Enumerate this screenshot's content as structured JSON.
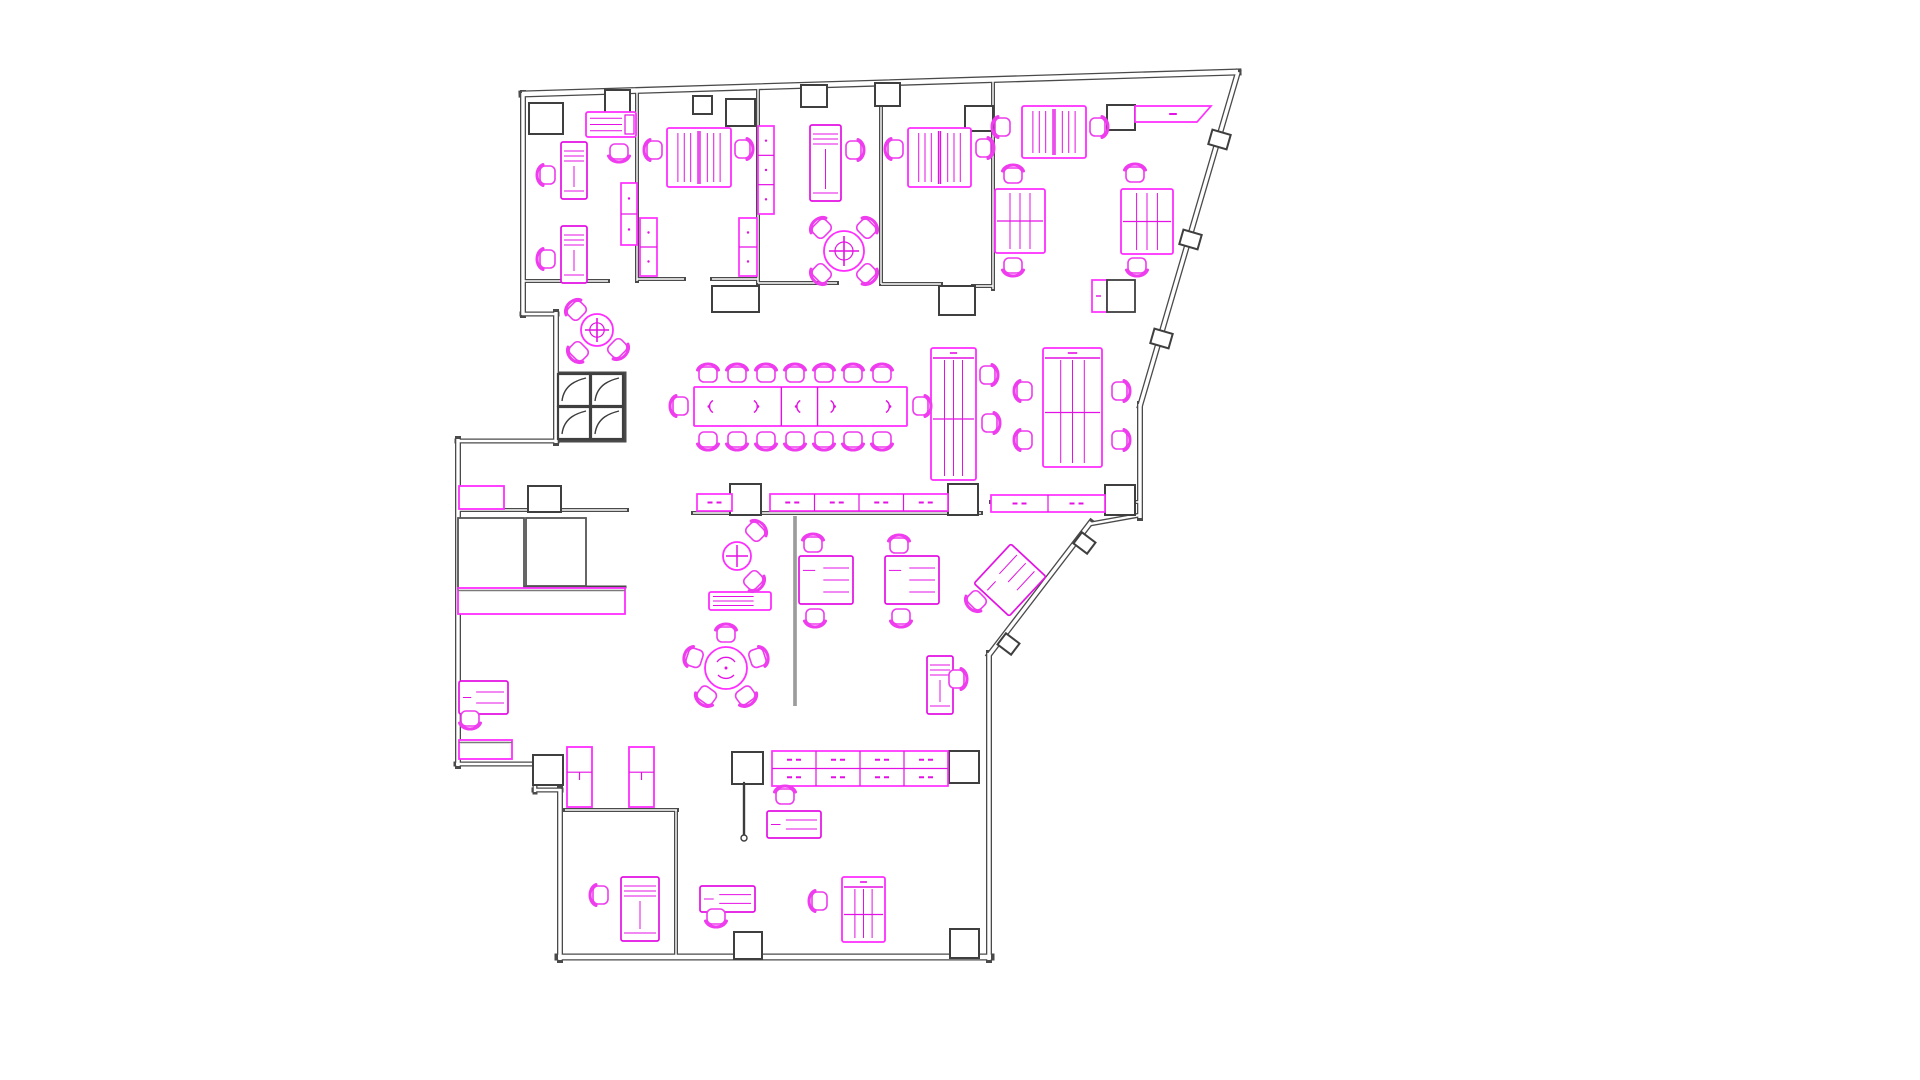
{
  "meta": {
    "page_background": "#ffffff",
    "drawing_type": "office-floor-plan"
  },
  "canvas": {
    "width": 1920,
    "height": 1080
  },
  "colors": {
    "wall": "#4a4a4a",
    "wall_light": "#6e6e6e",
    "wall_gap": "#ffffff",
    "column_stroke": "#3f3f3f",
    "column_fill": "#ffffff",
    "furniture": "#e411e4",
    "furniture_bright": "#ff2dff",
    "chair": "#ee3cee",
    "gray_item": "#565656",
    "screen": "#5a5a5a"
  },
  "plan": {
    "exterior_walls": [
      [
        522,
        94,
        1238,
        72,
        7
      ],
      [
        1238,
        72,
        1140,
        406,
        6
      ],
      [
        1140,
        404,
        1140,
        518,
        6
      ],
      [
        1140,
        515,
        1090,
        524,
        5
      ],
      [
        1091,
        522,
        989,
        655,
        6
      ],
      [
        989,
        653,
        989,
        960,
        6
      ],
      [
        991,
        957,
        558,
        957,
        7
      ],
      [
        560,
        960,
        560,
        789,
        6
      ],
      [
        561,
        790,
        534,
        790,
        5
      ],
      [
        535,
        792,
        535,
        763,
        5
      ],
      [
        537,
        764,
        456,
        764,
        5
      ],
      [
        458,
        766,
        458,
        439,
        6
      ],
      [
        457,
        441,
        557,
        441,
        5
      ],
      [
        556,
        443,
        556,
        312,
        6
      ],
      [
        557,
        314,
        522,
        314,
        5
      ],
      [
        523,
        315,
        523,
        93,
        6
      ]
    ],
    "interior_walls": [
      [
        637,
        91,
        637,
        281,
        4
      ],
      [
        758,
        87,
        758,
        283,
        4
      ],
      [
        881,
        84,
        881,
        284,
        4
      ],
      [
        993,
        80,
        993,
        289,
        4
      ],
      [
        523,
        281,
        608,
        281,
        4
      ],
      [
        637,
        279,
        684,
        279,
        4
      ],
      [
        712,
        279,
        758,
        279,
        4
      ],
      [
        758,
        283,
        837,
        283,
        4
      ],
      [
        881,
        284,
        941,
        284,
        4
      ],
      [
        973,
        286,
        993,
        286,
        4
      ],
      [
        458,
        510,
        627,
        510,
        4
      ],
      [
        693,
        513,
        981,
        513,
        4
      ],
      [
        991,
        502,
        1140,
        502,
        4
      ],
      [
        565,
        810,
        677,
        810,
        4
      ],
      [
        676,
        810,
        676,
        957,
        4
      ],
      [
        457,
        587,
        625,
        587,
        3
      ],
      [
        557,
        373,
        625,
        373,
        3
      ],
      [
        625,
        373,
        625,
        441,
        3
      ],
      [
        557,
        441,
        625,
        441,
        3
      ]
    ],
    "columns": [
      [
        529,
        103,
        34,
        31,
        0
      ],
      [
        605,
        90,
        25,
        23,
        0
      ],
      [
        693,
        96,
        19,
        18,
        0
      ],
      [
        726,
        99,
        29,
        27,
        0
      ],
      [
        801,
        85,
        26,
        22,
        0
      ],
      [
        875,
        83,
        25,
        23,
        0
      ],
      [
        965,
        106,
        28,
        25,
        0
      ],
      [
        1107,
        105,
        28,
        25,
        0
      ],
      [
        712,
        286,
        47,
        26,
        0
      ],
      [
        939,
        286,
        36,
        29,
        0
      ],
      [
        528,
        486,
        33,
        26,
        0
      ],
      [
        730,
        484,
        31,
        31,
        0
      ],
      [
        948,
        484,
        30,
        31,
        0
      ],
      [
        1105,
        485,
        30,
        30,
        0
      ],
      [
        732,
        752,
        31,
        32,
        0
      ],
      [
        949,
        751,
        30,
        32,
        0
      ],
      [
        734,
        932,
        28,
        27,
        0
      ],
      [
        950,
        929,
        29,
        29,
        0
      ],
      [
        533,
        755,
        30,
        30,
        0
      ],
      [
        1210,
        132,
        19,
        15,
        16
      ],
      [
        1181,
        232,
        19,
        15,
        16
      ],
      [
        1152,
        331,
        19,
        15,
        16
      ],
      [
        1076,
        536,
        17,
        14,
        37
      ],
      [
        1000,
        637,
        17,
        14,
        37
      ]
    ],
    "louver_cells": [
      [
        558,
        374,
        32,
        32
      ],
      [
        591,
        374,
        32,
        32
      ],
      [
        558,
        407,
        32,
        32
      ],
      [
        591,
        407,
        32,
        32
      ]
    ],
    "furniture": [
      {
        "name": "office1-printer-table",
        "t": "sideboard",
        "x": 586,
        "y": 112,
        "w": 50,
        "h": 25,
        "endbox": true
      },
      {
        "name": "office1-desk-upper",
        "t": "desk_v",
        "x": 561,
        "y": 142,
        "w": 26,
        "h": 57
      },
      {
        "name": "office1-desk-lower",
        "t": "desk_v",
        "x": 561,
        "y": 226,
        "w": 26,
        "h": 57
      },
      {
        "name": "office1-cabinet",
        "t": "cabinet",
        "x": 621,
        "y": 183,
        "w": 16,
        "h": 62,
        "seg": 2
      },
      {
        "name": "office2-double-desk",
        "t": "desk_double",
        "x": 667,
        "y": 128,
        "w": 64,
        "h": 59
      },
      {
        "name": "office2-cabinet-west",
        "t": "cabinet",
        "x": 640,
        "y": 218,
        "w": 17,
        "h": 58,
        "seg": 2
      },
      {
        "name": "office2-cabinet-east",
        "t": "cabinet",
        "x": 739,
        "y": 218,
        "w": 18,
        "h": 58,
        "seg": 2
      },
      {
        "name": "office3-cabinet",
        "t": "cabinet",
        "x": 758,
        "y": 126,
        "w": 16,
        "h": 88,
        "seg": 3
      },
      {
        "name": "office3-desk",
        "t": "desk_v",
        "x": 810,
        "y": 125,
        "w": 31,
        "h": 76
      },
      {
        "name": "office3-meeting-table",
        "t": "round4",
        "x": 844,
        "y": 251,
        "r": 20
      },
      {
        "name": "office4-double-desk",
        "t": "desk_double",
        "x": 908,
        "y": 128,
        "w": 63,
        "h": 59
      },
      {
        "name": "open-area-top-desk",
        "t": "desk_double",
        "x": 1022,
        "y": 106,
        "w": 64,
        "h": 52
      },
      {
        "name": "open-area-credenza-slant",
        "t": "slant_credenza",
        "x": 1135,
        "y": 106,
        "w": 76,
        "h": 16
      },
      {
        "name": "open-area-bench-left",
        "t": "bench",
        "x": 995,
        "y": 189,
        "w": 50,
        "h": 64,
        "header": false
      },
      {
        "name": "open-area-bench-right",
        "t": "bench",
        "x": 1121,
        "y": 189,
        "w": 52,
        "h": 65,
        "header": false
      },
      {
        "name": "open-area-printer-stand",
        "t": "printer",
        "x": 1092,
        "y": 280,
        "w": 43,
        "h": 32
      },
      {
        "name": "open-area-bench-south",
        "t": "bench",
        "x": 1043,
        "y": 348,
        "w": 59,
        "h": 119,
        "header": true
      },
      {
        "name": "conference-bench",
        "t": "bench",
        "x": 931,
        "y": 348,
        "w": 45,
        "h": 132,
        "header": true
      },
      {
        "name": "conference-table",
        "t": "conf_table",
        "x": 694,
        "y": 387,
        "w": 213,
        "h": 39
      },
      {
        "name": "breakout-round-table",
        "t": "round3",
        "x": 597,
        "y": 330,
        "r": 16
      },
      {
        "name": "spine-credenza-small",
        "t": "credenza",
        "x": 697,
        "y": 494,
        "w": 35,
        "h": 17,
        "mod": 1,
        "rows": 1
      },
      {
        "name": "spine-credenza-main",
        "t": "credenza",
        "x": 770,
        "y": 494,
        "w": 178,
        "h": 17,
        "mod": 4,
        "rows": 1
      },
      {
        "name": "spine-credenza-east",
        "t": "credenza",
        "x": 991,
        "y": 495,
        "w": 114,
        "h": 17,
        "mod": 2,
        "rows": 1
      },
      {
        "name": "spine-worktop",
        "t": "worktop",
        "x": 459,
        "y": 486,
        "w": 45,
        "h": 23
      },
      {
        "name": "storage-table-1",
        "t": "table_gray",
        "x": 458,
        "y": 518,
        "w": 66,
        "h": 71
      },
      {
        "name": "storage-table-2",
        "t": "table_gray",
        "x": 526,
        "y": 518,
        "w": 60,
        "h": 68
      },
      {
        "name": "storage-counter",
        "t": "counter",
        "x": 458,
        "y": 588,
        "w": 167,
        "h": 26
      },
      {
        "name": "west-desk",
        "t": "desk_h",
        "x": 459,
        "y": 681,
        "w": 49,
        "h": 33
      },
      {
        "name": "west-counter",
        "t": "counter",
        "x": 459,
        "y": 740,
        "w": 53,
        "h": 19
      },
      {
        "name": "wardrobe-1",
        "t": "wardrobe",
        "x": 567,
        "y": 747,
        "w": 25,
        "h": 60
      },
      {
        "name": "wardrobe-2",
        "t": "wardrobe",
        "x": 629,
        "y": 747,
        "w": 25,
        "h": 60
      },
      {
        "name": "closet-desk",
        "t": "desk_v",
        "x": 621,
        "y": 877,
        "w": 38,
        "h": 64
      },
      {
        "name": "south-small-desk",
        "t": "desk_h",
        "x": 700,
        "y": 886,
        "w": 55,
        "h": 26
      },
      {
        "name": "coat-stand",
        "t": "coat",
        "x": 744,
        "y": 783,
        "h": 55
      },
      {
        "name": "reception-device",
        "t": "cross_circle",
        "x": 737,
        "y": 556,
        "r": 14
      },
      {
        "name": "reception-sideboard",
        "t": "sideboard",
        "x": 709,
        "y": 592,
        "w": 62,
        "h": 18,
        "endbox": false
      },
      {
        "name": "lounge-round-table",
        "t": "round5",
        "x": 726,
        "y": 668,
        "r": 21
      },
      {
        "name": "glass-screen",
        "t": "screen",
        "x1": 795,
        "y1": 516,
        "x2": 795,
        "y2": 706
      },
      {
        "name": "south-desk-a",
        "t": "desk_sq",
        "x": 799,
        "y": 556,
        "w": 54,
        "h": 48,
        "rot": 0
      },
      {
        "name": "south-desk-b",
        "t": "desk_sq",
        "x": 885,
        "y": 556,
        "w": 54,
        "h": 48,
        "rot": 0
      },
      {
        "name": "south-desk-angled",
        "t": "desk_sq",
        "x": 983,
        "y": 556,
        "w": 54,
        "h": 48,
        "rot": -47
      },
      {
        "name": "window-desk",
        "t": "desk_v",
        "x": 927,
        "y": 656,
        "w": 26,
        "h": 58
      },
      {
        "name": "south-credenza",
        "t": "credenza",
        "x": 772,
        "y": 751,
        "w": 176,
        "h": 35,
        "mod": 4,
        "rows": 2
      },
      {
        "name": "south-desk-c",
        "t": "desk_h",
        "x": 767,
        "y": 811,
        "w": 54,
        "h": 27
      },
      {
        "name": "corner-bench",
        "t": "bench",
        "x": 842,
        "y": 877,
        "w": 43,
        "h": 65,
        "header": true
      }
    ],
    "chairs": [
      [
        619,
        151,
        -90
      ],
      [
        548,
        175,
        0
      ],
      [
        548,
        259,
        0
      ],
      [
        655,
        150,
        0
      ],
      [
        742,
        149,
        180
      ],
      [
        853,
        150,
        180
      ],
      [
        822,
        229,
        45
      ],
      [
        866,
        229,
        135
      ],
      [
        822,
        273,
        -45
      ],
      [
        866,
        273,
        -135
      ],
      [
        896,
        149,
        0
      ],
      [
        983,
        148,
        180
      ],
      [
        1003,
        127,
        0
      ],
      [
        1097,
        127,
        180
      ],
      [
        1013,
        176,
        90
      ],
      [
        1013,
        265,
        -90
      ],
      [
        1135,
        175,
        90
      ],
      [
        1137,
        265,
        -90
      ],
      [
        1025,
        391,
        0
      ],
      [
        1025,
        440,
        0
      ],
      [
        1119,
        391,
        180
      ],
      [
        1119,
        440,
        180
      ],
      [
        987,
        375,
        180
      ],
      [
        989,
        423,
        180
      ],
      [
        708,
        375,
        90
      ],
      [
        737,
        375,
        90
      ],
      [
        766,
        375,
        90
      ],
      [
        795,
        375,
        90
      ],
      [
        824,
        375,
        90
      ],
      [
        853,
        375,
        90
      ],
      [
        882,
        375,
        90
      ],
      [
        708,
        439,
        -90
      ],
      [
        737,
        439,
        -90
      ],
      [
        766,
        439,
        -90
      ],
      [
        795,
        439,
        -90
      ],
      [
        824,
        439,
        -90
      ],
      [
        853,
        439,
        -90
      ],
      [
        882,
        439,
        -90
      ],
      [
        681,
        406,
        0
      ],
      [
        920,
        406,
        180
      ],
      [
        577,
        311,
        45
      ],
      [
        579,
        351,
        -45
      ],
      [
        617,
        348,
        -135
      ],
      [
        755,
        532,
        135
      ],
      [
        753,
        580,
        -135
      ],
      [
        726,
        635,
        90
      ],
      [
        757,
        658,
        162
      ],
      [
        745,
        695,
        234
      ],
      [
        707,
        695,
        306
      ],
      [
        695,
        658,
        18
      ],
      [
        813,
        545,
        90
      ],
      [
        815,
        616,
        -90
      ],
      [
        899,
        546,
        90
      ],
      [
        901,
        616,
        -90
      ],
      [
        977,
        600,
        -45
      ],
      [
        956,
        679,
        180
      ],
      [
        785,
        797,
        90
      ],
      [
        820,
        901,
        0
      ],
      [
        601,
        895,
        0
      ],
      [
        716,
        916,
        -90
      ],
      [
        470,
        718,
        -90
      ]
    ]
  }
}
